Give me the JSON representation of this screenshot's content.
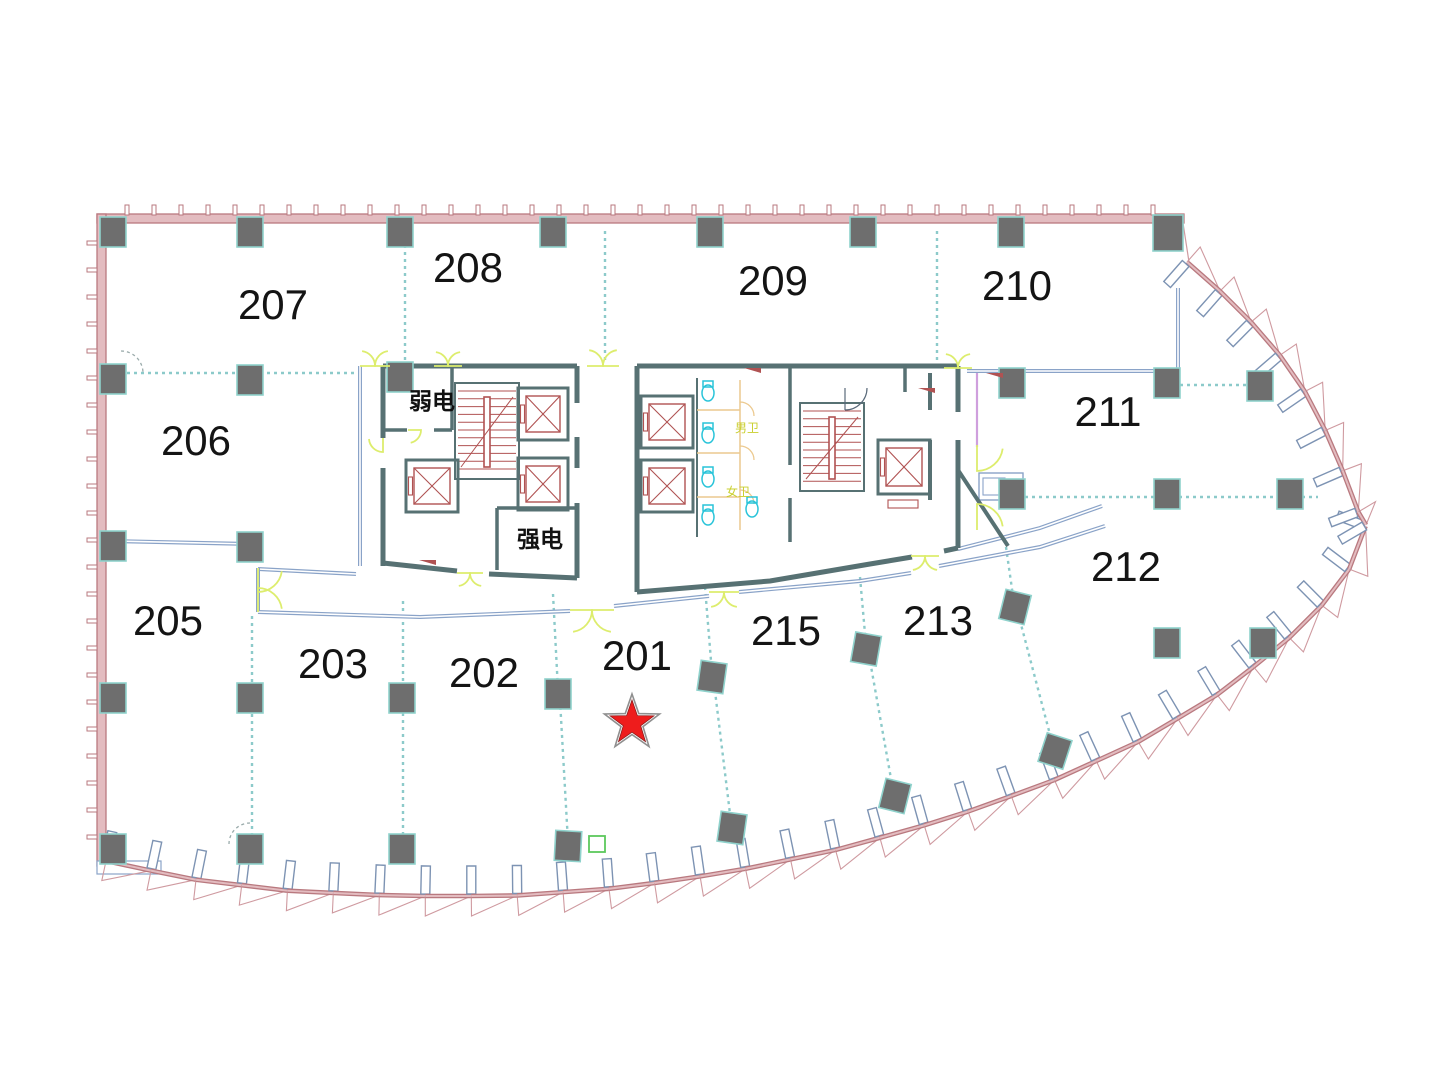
{
  "page": {
    "background": "#ffffff",
    "type": "architectural-floor-plan"
  },
  "rooms": [
    {
      "number": "207",
      "x": 273,
      "y": 319
    },
    {
      "number": "208",
      "x": 468,
      "y": 282
    },
    {
      "number": "209",
      "x": 773,
      "y": 295
    },
    {
      "number": "210",
      "x": 1017,
      "y": 300
    },
    {
      "number": "206",
      "x": 196,
      "y": 455
    },
    {
      "number": "211",
      "x": 1108,
      "y": 426
    },
    {
      "number": "212",
      "x": 1126,
      "y": 581
    },
    {
      "number": "205",
      "x": 168,
      "y": 635
    },
    {
      "number": "203",
      "x": 333,
      "y": 678
    },
    {
      "number": "202",
      "x": 484,
      "y": 687
    },
    {
      "number": "201",
      "x": 637,
      "y": 670
    },
    {
      "number": "215",
      "x": 786,
      "y": 645
    },
    {
      "number": "213",
      "x": 938,
      "y": 635
    }
  ],
  "utility_rooms": [
    {
      "name": "弱电",
      "x": 432,
      "y": 409
    },
    {
      "name": "强电",
      "x": 540,
      "y": 547
    }
  ],
  "toilet_labels": [
    {
      "name": "男卫",
      "x": 747,
      "y": 432
    },
    {
      "name": "女卫",
      "x": 738,
      "y": 496
    }
  ],
  "marker": {
    "shape": "star",
    "x": 632,
    "y": 723,
    "color": "#ee1c1c"
  },
  "colors": {
    "facade_edge": "#b9797f",
    "facade_fill": "#e3bcc0",
    "facade_thin": "#cf9aa0",
    "fin_edge": "#7d93b3",
    "column": "#6e6e6e",
    "column_outline": "#8fd2cc",
    "core_wall": "#577173",
    "partition": "#8ccaca",
    "corridor_wall": "#8aa3c8",
    "door": "#dded6d",
    "stair": "#b05252",
    "fixture": "#29c4d9",
    "stall": "#ecc98f",
    "purple": "#cf9fdd",
    "accent_green": "#5cc85c",
    "label": "#141414"
  }
}
